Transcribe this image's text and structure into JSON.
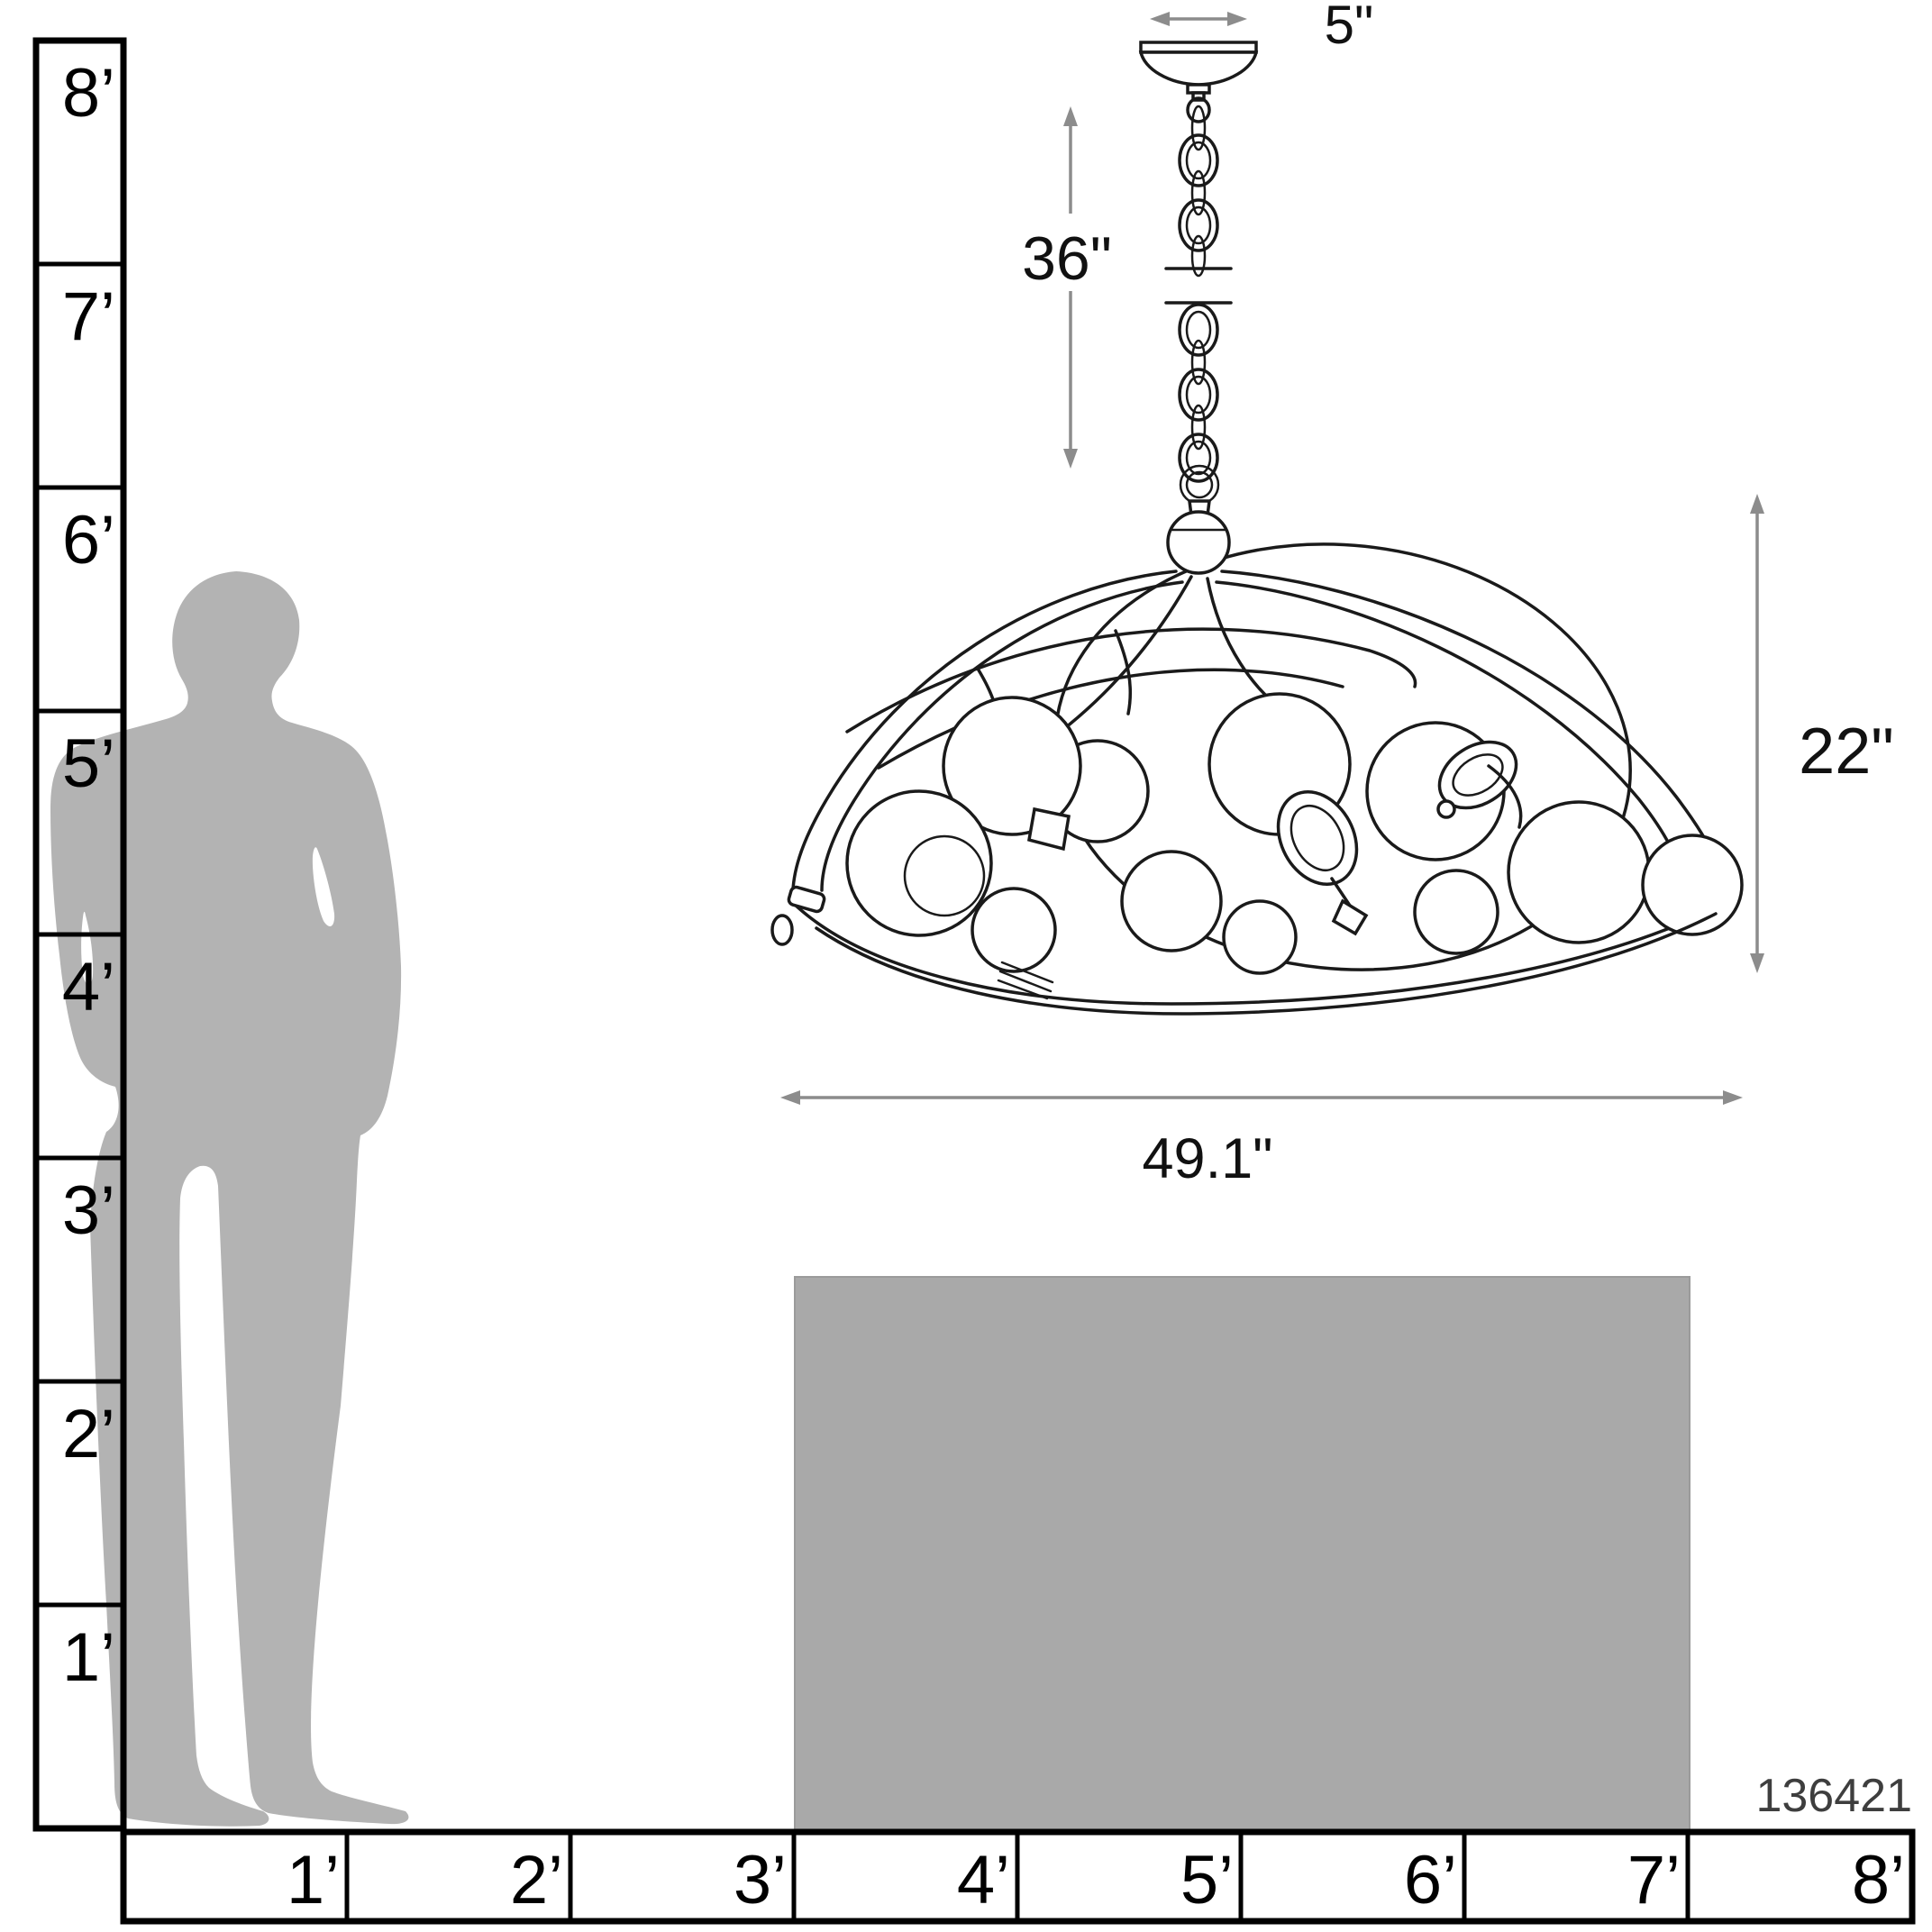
{
  "diagram": {
    "product_number": "136421",
    "dimensions": {
      "canopy_width": "5\"",
      "chain_length": "36\"",
      "fixture_height": "22\"",
      "fixture_width": "49.1\""
    },
    "vertical_scale": {
      "unit": "feet",
      "labels": [
        "8’",
        "7’",
        "6’",
        "5’",
        "4’",
        "3’",
        "2’",
        "1’"
      ]
    },
    "horizontal_scale": {
      "unit": "feet",
      "labels": [
        "1’",
        "2’",
        "3’",
        "4’",
        "5’",
        "6’",
        "7’",
        "8’"
      ]
    },
    "colors": {
      "silhouette_gray": "#b3b3b3",
      "table_gray": "#a9a9a9",
      "dimension_gray": "#8c8c8c",
      "line_black": "#1a1a1a"
    }
  }
}
